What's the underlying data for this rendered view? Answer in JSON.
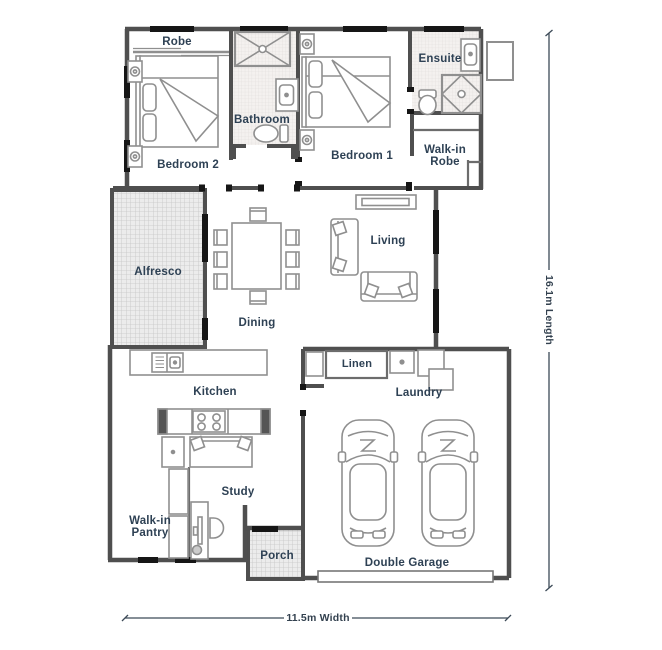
{
  "canvas": {
    "width": 662,
    "height": 650,
    "background": "#ffffff"
  },
  "palette": {
    "wall": "#4f4f4f",
    "window_door": "#161616",
    "furniture_line": "#8f8f8f",
    "label_text": "#2e4154",
    "hatch_bg": "#ececec",
    "hatch_line": "#c6c6c6",
    "tile_bg": "#f4f1ef",
    "tile_line": "#e0dcda"
  },
  "rooms": {
    "robe": {
      "label": "Robe"
    },
    "bathroom": {
      "label": "Bathroom"
    },
    "bedroom2": {
      "label": "Bedroom 2"
    },
    "bedroom1": {
      "label": "Bedroom 1"
    },
    "ensuite": {
      "label": "Ensuite"
    },
    "walk_in_robe": {
      "line1": "Walk-in",
      "line2": "Robe"
    },
    "alfresco": {
      "label": "Alfresco"
    },
    "dining": {
      "label": "Dining"
    },
    "living": {
      "label": "Living"
    },
    "kitchen": {
      "label": "Kitchen"
    },
    "linen": {
      "label": "Linen"
    },
    "laundry": {
      "label": "Laundry"
    },
    "study": {
      "label": "Study"
    },
    "walk_in_pantry": {
      "line1": "Walk-in",
      "line2": "Pantry"
    },
    "porch": {
      "label": "Porch"
    },
    "double_garage": {
      "label": "Double Garage"
    }
  },
  "dimensions": {
    "width_label": "11.5m Width",
    "length_label": "16.1m Length"
  },
  "icons": [
    "double-bed-icon",
    "bedside-table-icon",
    "shower-icon",
    "vanity-sink-icon",
    "toilet-icon",
    "wardrobe-shelf-icon",
    "tv-unit-icon",
    "sofa-icon",
    "dining-table-icon",
    "dining-chair-icon",
    "kitchen-sink-icon",
    "island-bench-icon",
    "cooktop-icon",
    "breakfast-table-icon",
    "pantry-shelf-icon",
    "desk-icon",
    "desk-chair-icon",
    "laundry-tub-icon",
    "washing-machine-icon",
    "linen-cupboard-icon",
    "car-icon",
    "garage-door-icon",
    "dimension-line-icon",
    "hot-water-unit-icon"
  ]
}
